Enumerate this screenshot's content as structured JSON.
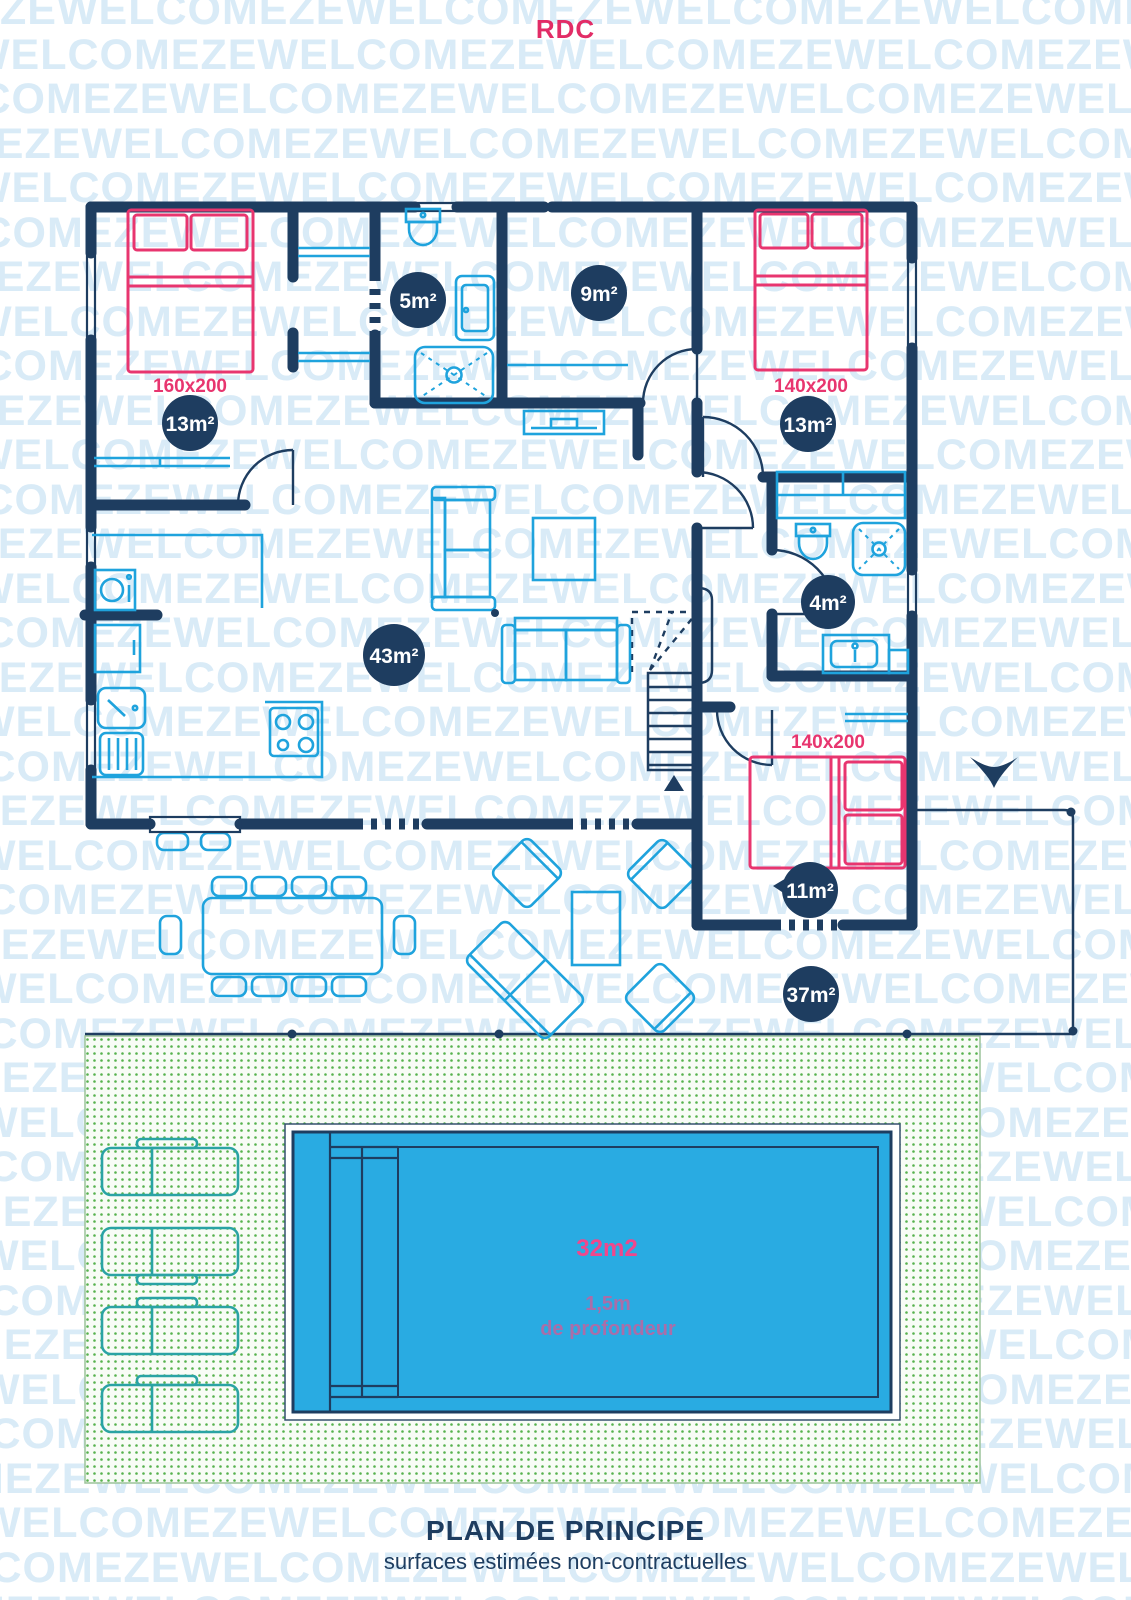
{
  "title": "RDC",
  "watermark": {
    "text": "ZEWELCOME"
  },
  "plan": {
    "rooms": [
      {
        "name": "bedroom-1",
        "area_label": "13m²"
      },
      {
        "name": "bathroom-1",
        "area_label": "5m²"
      },
      {
        "name": "hall",
        "area_label": "9m²"
      },
      {
        "name": "bedroom-2",
        "area_label": "13m²"
      },
      {
        "name": "living-kitchen",
        "area_label": "43m²"
      },
      {
        "name": "bathroom-2",
        "area_label": "4m²"
      },
      {
        "name": "bedroom-3",
        "area_label": "11m²"
      },
      {
        "name": "terrace",
        "area_label": "37m²"
      }
    ],
    "beds": [
      {
        "room": "bedroom-1",
        "size_label": "160x200"
      },
      {
        "room": "bedroom-2",
        "size_label": "140x200"
      },
      {
        "room": "bedroom-3",
        "size_label": "140x200"
      }
    ],
    "pool": {
      "area_label": "32m2",
      "depth_label_line1": "1,5m",
      "depth_label_line2": "de profondeur"
    }
  },
  "footer": {
    "title": "PLAN DE PRINCIPE",
    "subtitle": "surfaces estimées non-contractuelles"
  },
  "colors": {
    "c-navy": "#1e3d60",
    "c-blue": "#1fa3dd",
    "c-pink": "#e8356f",
    "c-teal": "#2aa3a4",
    "c-pool": "#29abe2",
    "c-grassdot": "#57b24e",
    "c-watermark": "#d9ebf7",
    "c-title": "#e22c66",
    "c-depth": "#b06ba6",
    "c-poolarea": "#f0478c"
  }
}
